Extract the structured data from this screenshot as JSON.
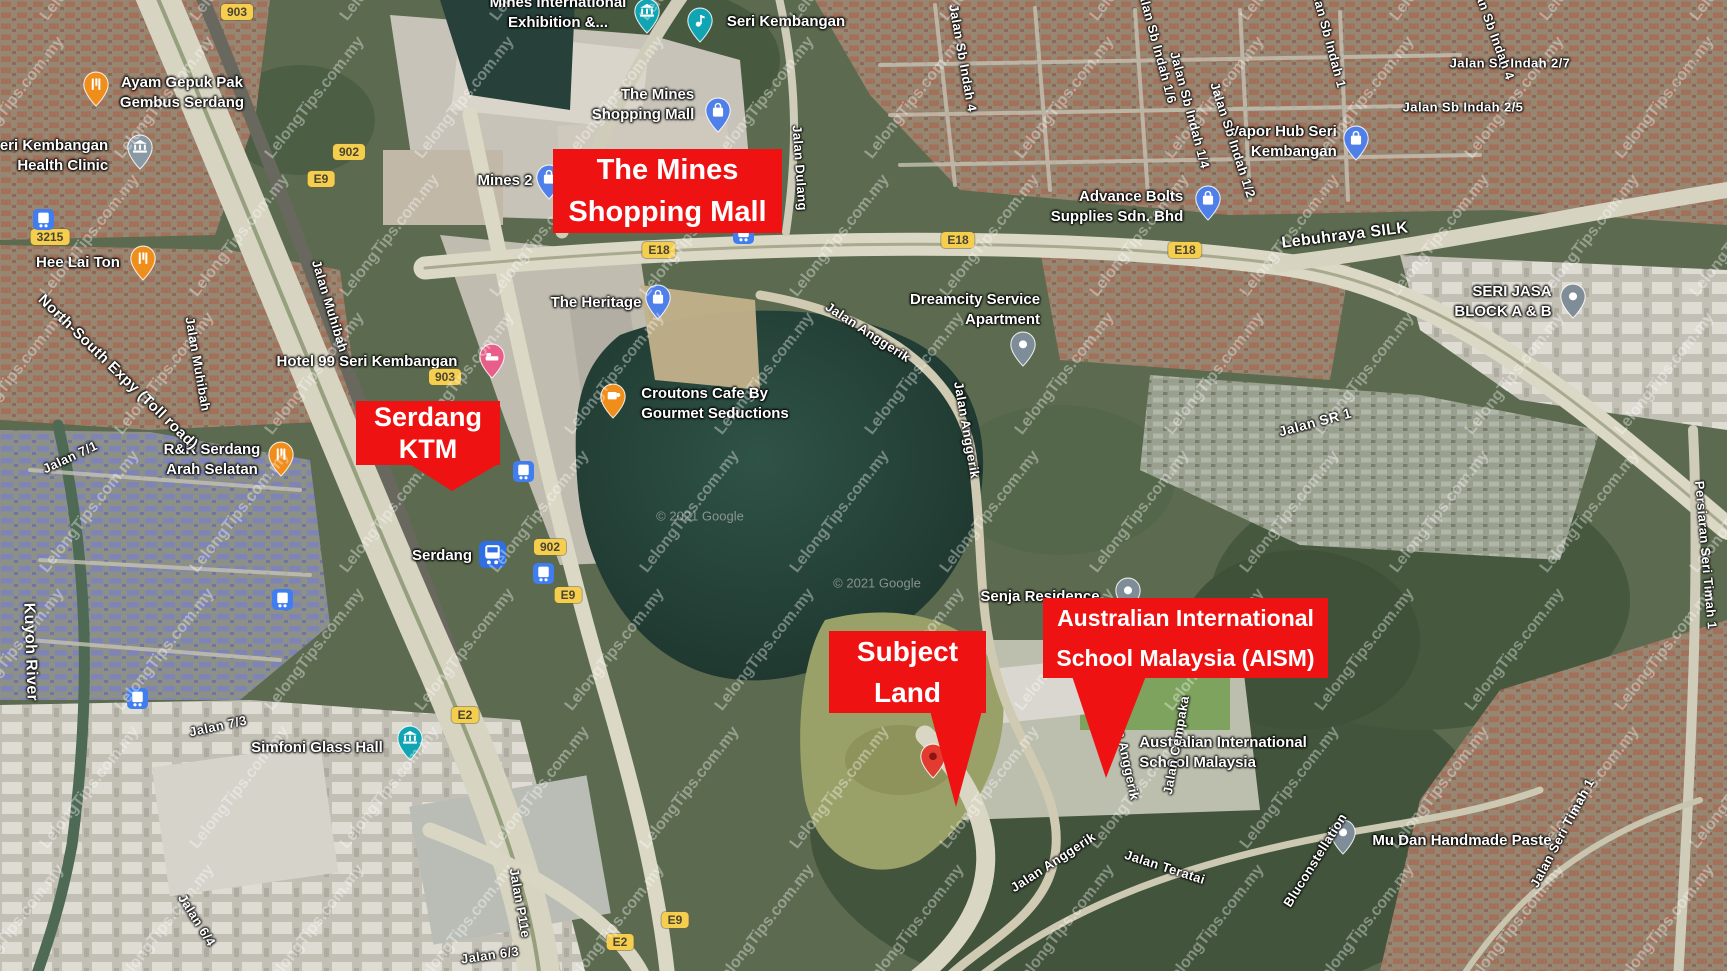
{
  "annotation_color": "#ee1212",
  "watermark": {
    "text": "LelongTips.com.my",
    "rotation_deg": -52,
    "font_px": 16,
    "color": "rgba(255,255,255,0.36)",
    "step_x": 150,
    "step_y": 138,
    "row_offset": 75
  },
  "attribution": {
    "text": "© 2021 Google",
    "positions": [
      [
        700,
        516
      ],
      [
        877,
        583
      ]
    ]
  },
  "annotations": [
    {
      "id": "the-mines-shopping-mall",
      "lines": [
        "The Mines",
        "Shopping Mall"
      ],
      "box": {
        "x": 553,
        "y": 149,
        "w": 229,
        "h": 84
      },
      "font_px": 29,
      "pointer": null,
      "marker": null
    },
    {
      "id": "serdang-ktm",
      "lines": [
        "Serdang",
        "KTM"
      ],
      "box": {
        "x": 356,
        "y": 401,
        "w": 144,
        "h": 64
      },
      "font_px": 27,
      "pointer": [
        [
          408,
          463
        ],
        [
          500,
          463
        ],
        [
          452,
          491
        ]
      ],
      "marker": null
    },
    {
      "id": "subject-land",
      "lines": [
        "Subject",
        "Land"
      ],
      "box": {
        "x": 829,
        "y": 631,
        "w": 157,
        "h": 82
      },
      "font_px": 28,
      "pointer": [
        [
          930,
          711
        ],
        [
          982,
          711
        ],
        [
          956,
          807
        ]
      ],
      "marker": {
        "x": 933,
        "y": 758
      }
    },
    {
      "id": "aism",
      "lines": [
        "Australian International",
        "School Malaysia (AISM)"
      ],
      "box": {
        "x": 1043,
        "y": 598,
        "w": 285,
        "h": 80
      },
      "font_px": 23,
      "pointer": [
        [
          1072,
          676
        ],
        [
          1146,
          676
        ],
        [
          1106,
          778
        ]
      ],
      "marker": null
    }
  ],
  "poi_labels": [
    {
      "id": "mines-international-exhibition",
      "lines": [
        "Mines International",
        "Exhibition &..."
      ],
      "x": 558,
      "y": 13,
      "align": "center",
      "pin": {
        "x": 647,
        "y": 13,
        "type": "museum",
        "color": "#11a5b4"
      }
    },
    {
      "id": "seri-kembangan",
      "lines": [
        "Seri Kembangan"
      ],
      "x": 786,
      "y": 22,
      "align": "left",
      "pin": {
        "x": 700,
        "y": 22,
        "type": "music",
        "color": "#11a5b4"
      }
    },
    {
      "id": "the-mines-shopping-mall-poi",
      "lines": [
        "The Mines",
        "Shopping Mall"
      ],
      "x": 643,
      "y": 105,
      "align": "right",
      "pin": {
        "x": 718,
        "y": 112,
        "type": "shopping",
        "color": "#4f7fe8"
      }
    },
    {
      "id": "mines-2",
      "lines": [
        "Mines 2"
      ],
      "x": 505,
      "y": 181,
      "align": "left",
      "pin": {
        "x": 549,
        "y": 179,
        "type": "shopping",
        "color": "#4f7fe8"
      }
    },
    {
      "id": "ayam-gepuk-pak-gembus-serdang",
      "lines": [
        "Ayam Gepuk Pak",
        "Gembus Serdang"
      ],
      "x": 182,
      "y": 93,
      "align": "center",
      "pin": {
        "x": 96,
        "y": 86,
        "type": "restaurant",
        "color": "#ef8e1b"
      }
    },
    {
      "id": "seri-kembangan-health-clinic",
      "lines": [
        "Seri Kembangan",
        "Health Clinic"
      ],
      "x": 49,
      "y": 156,
      "align": "right",
      "pin": {
        "x": 140,
        "y": 149,
        "type": "civic",
        "color": "#8a9aa5"
      }
    },
    {
      "id": "hee-lai-ton",
      "lines": [
        "Hee Lai Ton"
      ],
      "x": 78,
      "y": 263,
      "align": "center",
      "pin": {
        "x": 143,
        "y": 260,
        "type": "restaurant",
        "color": "#ef8e1b"
      }
    },
    {
      "id": "hotel-99-seri-kembangan",
      "lines": [
        "Hotel 99 Seri Kembangan"
      ],
      "x": 367,
      "y": 362,
      "align": "center",
      "pin": {
        "x": 492,
        "y": 358,
        "type": "hotel",
        "color": "#e85d8a"
      }
    },
    {
      "id": "rr-serdang-arah-selatan",
      "lines": [
        "R&R Serdang",
        "Arah Selatan"
      ],
      "x": 212,
      "y": 460,
      "align": "center",
      "pin": {
        "x": 281,
        "y": 456,
        "type": "restaurant",
        "color": "#ef8e1b"
      }
    },
    {
      "id": "the-heritage",
      "lines": [
        "The Heritage"
      ],
      "x": 596,
      "y": 303,
      "align": "center",
      "pin": {
        "x": 658,
        "y": 299,
        "type": "shopping",
        "color": "#4f7fe8"
      }
    },
    {
      "id": "croutons-cafe",
      "lines": [
        "Croutons Cafe By",
        "Gourmet Seductions"
      ],
      "x": 715,
      "y": 404,
      "align": "left",
      "pin": {
        "x": 613,
        "y": 398,
        "type": "cafe",
        "color": "#ef8e1b"
      }
    },
    {
      "id": "dreamcity-service-apartment",
      "lines": [
        "Dreamcity Service",
        "Apartment"
      ],
      "x": 975,
      "y": 310,
      "align": "right",
      "pin": {
        "x": 1023,
        "y": 346,
        "type": "generic",
        "color": "#7f8d98"
      }
    },
    {
      "id": "advance-bolts",
      "lines": [
        "Advance Bolts",
        "Supplies Sdn. Bhd"
      ],
      "x": 1117,
      "y": 207,
      "align": "right",
      "pin": {
        "x": 1208,
        "y": 200,
        "type": "shopping",
        "color": "#4f7fe8"
      }
    },
    {
      "id": "vapor-hub-seri-kembangan",
      "lines": [
        "Vapor Hub Seri",
        "Kembangan"
      ],
      "x": 1283,
      "y": 142,
      "align": "right",
      "pin": {
        "x": 1356,
        "y": 140,
        "type": "shopping",
        "color": "#4f7fe8"
      }
    },
    {
      "id": "seri-jasa-block-a-b",
      "lines": [
        "SERI JASA",
        "BLOCK A & B"
      ],
      "x": 1503,
      "y": 302,
      "align": "right",
      "pin": {
        "x": 1573,
        "y": 298,
        "type": "generic",
        "color": "#7f8d98"
      }
    },
    {
      "id": "senja-residence",
      "lines": [
        "Senja Residence"
      ],
      "x": 1040,
      "y": 597,
      "align": "center",
      "pin": {
        "x": 1128,
        "y": 592,
        "type": "generic",
        "color": "#7f8d98"
      }
    },
    {
      "id": "australian-international-school-malaysia",
      "lines": [
        "Australian International",
        "School Malaysia"
      ],
      "x": 1223,
      "y": 753,
      "align": "left",
      "pin": null
    },
    {
      "id": "mu-dan-handmade-paste",
      "lines": [
        "Mu Dan Handmade Paste"
      ],
      "x": 1462,
      "y": 841,
      "align": "left",
      "pin": {
        "x": 1343,
        "y": 834,
        "type": "generic",
        "color": "#7f8d98"
      }
    },
    {
      "id": "simfoni-glass-hall",
      "lines": [
        "Simfoni Glass Hall"
      ],
      "x": 317,
      "y": 748,
      "align": "center",
      "pin": {
        "x": 410,
        "y": 740,
        "type": "museum",
        "color": "#11a5b4"
      }
    },
    {
      "id": "serdang-station",
      "lines": [
        "Serdang"
      ],
      "x": 442,
      "y": 556,
      "align": "center",
      "pin": {
        "x": 493,
        "y": 556,
        "type": "train",
        "color": "#2f6fe3"
      }
    }
  ],
  "road_labels": [
    {
      "text": "Jalan Dulang",
      "x": 800,
      "y": 168,
      "rot": 86
    },
    {
      "text": "Lebuhraya SILK",
      "x": 1345,
      "y": 236,
      "rot": -7,
      "size": 16
    },
    {
      "text": "North-South Expy (Toll road)",
      "x": 118,
      "y": 372,
      "rot": 44,
      "size": 15
    },
    {
      "text": "Jalan Muhibah",
      "x": 330,
      "y": 306,
      "rot": 73
    },
    {
      "text": "Jalan Muhibah",
      "x": 198,
      "y": 364,
      "rot": 80
    },
    {
      "text": "Jalan 7/1",
      "x": 70,
      "y": 457,
      "rot": -25
    },
    {
      "text": "Kuyoh River",
      "x": 30,
      "y": 652,
      "rot": 88,
      "size": 16
    },
    {
      "text": "Jalan 7/3",
      "x": 218,
      "y": 726,
      "rot": -12
    },
    {
      "text": "Jalan 6/4",
      "x": 197,
      "y": 920,
      "rot": 58
    },
    {
      "text": "Jalan 6/3",
      "x": 490,
      "y": 955,
      "rot": -8
    },
    {
      "text": "Jalan P11e",
      "x": 520,
      "y": 903,
      "rot": 80
    },
    {
      "text": "Jalan Anggerik",
      "x": 868,
      "y": 332,
      "rot": 33
    },
    {
      "text": "Jalan Anggerik",
      "x": 967,
      "y": 430,
      "rot": 80
    },
    {
      "text": "Jalan Anggerik",
      "x": 1125,
      "y": 752,
      "rot": 78
    },
    {
      "text": "Jalan Anggerik",
      "x": 1053,
      "y": 862,
      "rot": -33
    },
    {
      "text": "Jalan Cempaka",
      "x": 1176,
      "y": 745,
      "rot": -80
    },
    {
      "text": "Jalan Teratai",
      "x": 1165,
      "y": 867,
      "rot": 18
    },
    {
      "text": "Bluconstellation",
      "x": 1315,
      "y": 860,
      "rot": -58
    },
    {
      "text": "Jalan Seri Timah 1",
      "x": 1562,
      "y": 833,
      "rot": -62
    },
    {
      "text": "Persiaran Seri Timah 1",
      "x": 1706,
      "y": 555,
      "rot": 85
    },
    {
      "text": "Jalan Sb Indah 4",
      "x": 963,
      "y": 58,
      "rot": 80
    },
    {
      "text": "Jalan Sb Indah 1/6",
      "x": 1157,
      "y": 45,
      "rot": 75
    },
    {
      "text": "Jalan Sb Indah 1/4",
      "x": 1190,
      "y": 110,
      "rot": 75
    },
    {
      "text": "Jalan Sb Indah 1/2",
      "x": 1233,
      "y": 140,
      "rot": 72
    },
    {
      "text": "Jalan Sb Indah 2/7",
      "x": 1510,
      "y": 63,
      "rot": 0
    },
    {
      "text": "Jalan Sb Indah 2/5",
      "x": 1463,
      "y": 107,
      "rot": 0
    },
    {
      "text": "Jalan Sb Indah 1",
      "x": 1328,
      "y": 35,
      "rot": 75
    },
    {
      "text": "Jalan Sb Indah 4",
      "x": 1492,
      "y": 28,
      "rot": 70
    },
    {
      "text": "Jalan SR 1",
      "x": 1315,
      "y": 422,
      "rot": -15,
      "size": 14
    }
  ],
  "shields": [
    {
      "text": "903",
      "x": 237,
      "y": 12
    },
    {
      "text": "3215",
      "x": 50,
      "y": 237
    },
    {
      "text": "902",
      "x": 349,
      "y": 152
    },
    {
      "text": "E9",
      "x": 321,
      "y": 179
    },
    {
      "text": "903",
      "x": 445,
      "y": 377
    },
    {
      "text": "902",
      "x": 550,
      "y": 547
    },
    {
      "text": "E9",
      "x": 568,
      "y": 595
    },
    {
      "text": "E18",
      "x": 659,
      "y": 250
    },
    {
      "text": "E18",
      "x": 958,
      "y": 240
    },
    {
      "text": "E18",
      "x": 1185,
      "y": 250
    },
    {
      "text": "E2",
      "x": 465,
      "y": 715
    },
    {
      "text": "E2",
      "x": 620,
      "y": 942
    },
    {
      "text": "E9",
      "x": 675,
      "y": 920
    }
  ],
  "transit_icons": [
    {
      "x": 43,
      "y": 219
    },
    {
      "x": 743,
      "y": 233
    },
    {
      "x": 523,
      "y": 471
    },
    {
      "x": 543,
      "y": 573
    },
    {
      "x": 282,
      "y": 599
    },
    {
      "x": 137,
      "y": 698
    }
  ]
}
